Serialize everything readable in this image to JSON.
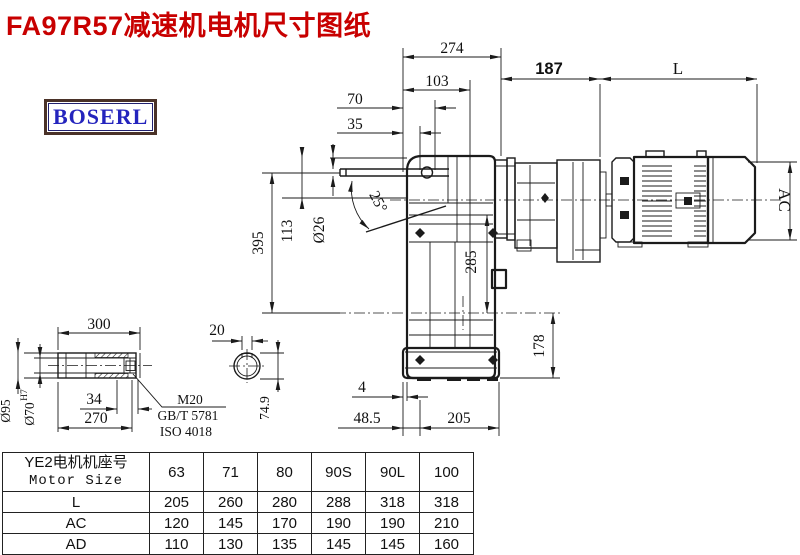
{
  "title": "FA97R57减速机电机尺寸图纸",
  "logo": "BOSERL",
  "drawing": {
    "dims": {
      "d274": "274",
      "d103": "103",
      "d70": "70",
      "d35": "35",
      "d187": "187",
      "L": "L",
      "AC": "AC",
      "d395": "395",
      "d113": "113",
      "dia26": "Ø26",
      "angle25": "25°",
      "d285": "285",
      "d178": "178",
      "d4": "4",
      "d48_5": "48.5",
      "d205": "205",
      "d300": "300",
      "d34": "34",
      "d270": "270",
      "dia95": "Ø95",
      "dia70": "Ø70",
      "dia70_tol": "H7",
      "m20": "M20",
      "gbt": "GB/T 5781",
      "iso": "ISO 4018",
      "d20": "20",
      "d74_9": "74.9"
    }
  },
  "table": {
    "header_cn": "YE2电机机座号",
    "header_en": "Motor Size",
    "sizes": [
      "63",
      "71",
      "80",
      "90S",
      "90L",
      "100"
    ],
    "rows": [
      {
        "label": "L",
        "values": [
          "205",
          "260",
          "280",
          "288",
          "318",
          "318"
        ]
      },
      {
        "label": "AC",
        "values": [
          "120",
          "145",
          "170",
          "190",
          "190",
          "210"
        ]
      },
      {
        "label": "AD",
        "values": [
          "110",
          "130",
          "135",
          "145",
          "145",
          "160"
        ]
      }
    ]
  },
  "colors": {
    "title": "#c80000",
    "logo_text": "#2424bd",
    "logo_border": "#4a3228",
    "line": "#1b1b1b"
  }
}
